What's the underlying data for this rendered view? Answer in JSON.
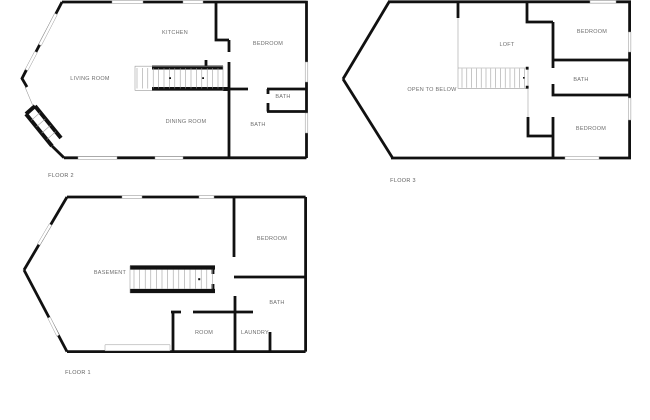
{
  "colors": {
    "wall": "#111111",
    "window_outline": "#999999",
    "room_label": "#6e6e6e",
    "floor_label": "#5f5f5f",
    "background": "#ffffff"
  },
  "floors": [
    {
      "id": "floor-2",
      "label": "FLOOR 2",
      "rooms": [
        {
          "label": "LIVING ROOM"
        },
        {
          "label": "KITCHEN"
        },
        {
          "label": "BEDROOM"
        },
        {
          "label": "DINING ROOM"
        },
        {
          "label": "BATH"
        },
        {
          "label": "BATH"
        }
      ]
    },
    {
      "id": "floor-3",
      "label": "FLOOR 3",
      "rooms": [
        {
          "label": "LOFT"
        },
        {
          "label": "OPEN TO BELOW"
        },
        {
          "label": "BEDROOM"
        },
        {
          "label": "BATH"
        },
        {
          "label": "BEDROOM"
        }
      ]
    },
    {
      "id": "floor-1",
      "label": "FLOOR 1",
      "rooms": [
        {
          "label": "BASEMENT"
        },
        {
          "label": "BEDROOM"
        },
        {
          "label": "BATH"
        },
        {
          "label": "ROOM"
        },
        {
          "label": "LAUNDRY"
        }
      ]
    }
  ]
}
